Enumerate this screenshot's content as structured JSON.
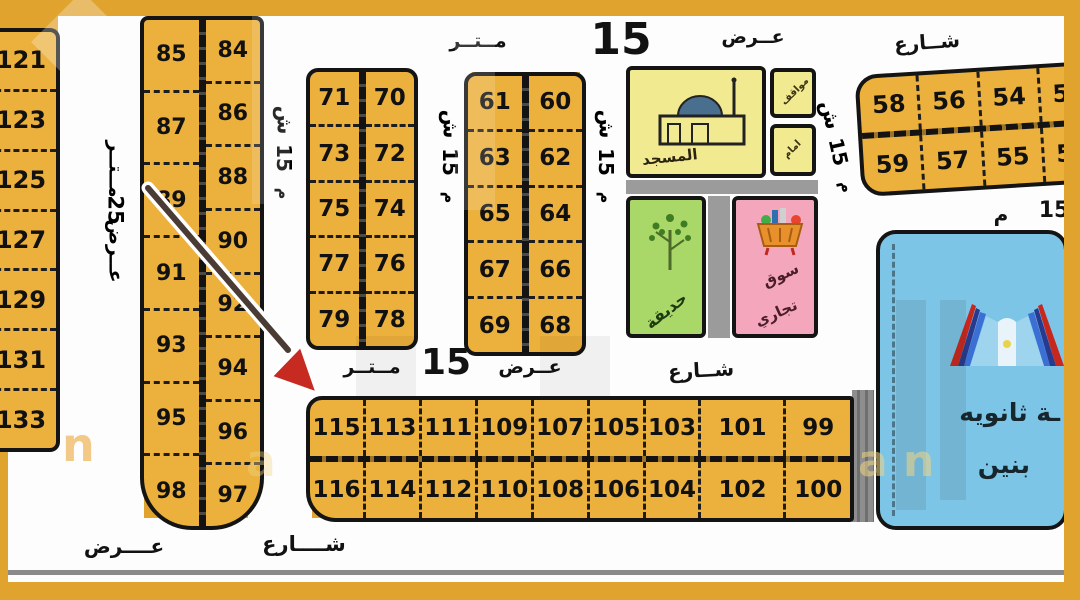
{
  "streets": {
    "top": {
      "street": "شــارع",
      "width": "عــرض",
      "size": "15",
      "unit": "مــتــر"
    },
    "left": {
      "unit": "مــتــر",
      "size": "25",
      "width": "عــرض"
    },
    "cross": {
      "shin": "ش",
      "size": "15",
      "meem": "م"
    },
    "bottom_mid": {
      "unit": "مــتــر",
      "size": "15",
      "width": "عــرض",
      "street": "شــارع"
    },
    "bottom": {
      "street": "شــــارع",
      "width": "عــــرض"
    },
    "right_edge": {
      "meem": "م",
      "size": "15"
    }
  },
  "plots": {
    "col_121_133": [
      "121",
      "123",
      "125",
      "127",
      "129",
      "131",
      "133"
    ],
    "col_85_98": [
      "85",
      "87",
      "89",
      "91",
      "93",
      "95",
      "98"
    ],
    "col_84_97": [
      "84",
      "86",
      "88",
      "90",
      "92",
      "94",
      "96",
      "97"
    ],
    "block_70s_left": [
      "71",
      "73",
      "75",
      "77",
      "79"
    ],
    "block_70s_right": [
      "70",
      "72",
      "74",
      "76",
      "78"
    ],
    "block_60s_left": [
      "61",
      "63",
      "65",
      "67",
      "69"
    ],
    "block_60s_right": [
      "60",
      "62",
      "64",
      "66",
      "68"
    ],
    "block_50s_top": [
      "58",
      "56",
      "54",
      "52"
    ],
    "block_50s_bottom": [
      "59",
      "57",
      "55",
      "53"
    ],
    "south_row_upper": [
      "115",
      "113",
      "111",
      "109",
      "107",
      "105",
      "103",
      "101",
      "99"
    ],
    "south_row_lower": [
      "116",
      "114",
      "112",
      "110",
      "108",
      "106",
      "104",
      "102",
      "100"
    ]
  },
  "facilities": {
    "mosque": "المسجد",
    "annex_top": "مواقف",
    "annex_bottom": "امام",
    "park": "حديقة",
    "market_line1": "سوق",
    "market_line2": "تجاري",
    "school_line1": "ـة ثانويه",
    "school_line2": "بنين"
  },
  "colors": {
    "background_gold": "#DFA32E",
    "plot_fill": "#ECB03C",
    "street_white": "#FDFDFD",
    "road_gray": "#9B9B9B",
    "mosque_fill": "#F2EA90",
    "park_fill": "#A9D768",
    "market_fill": "#F4A6BC",
    "school_fill": "#7CC5E7",
    "arrow_red": "#C62A20",
    "line_black": "#141414"
  }
}
